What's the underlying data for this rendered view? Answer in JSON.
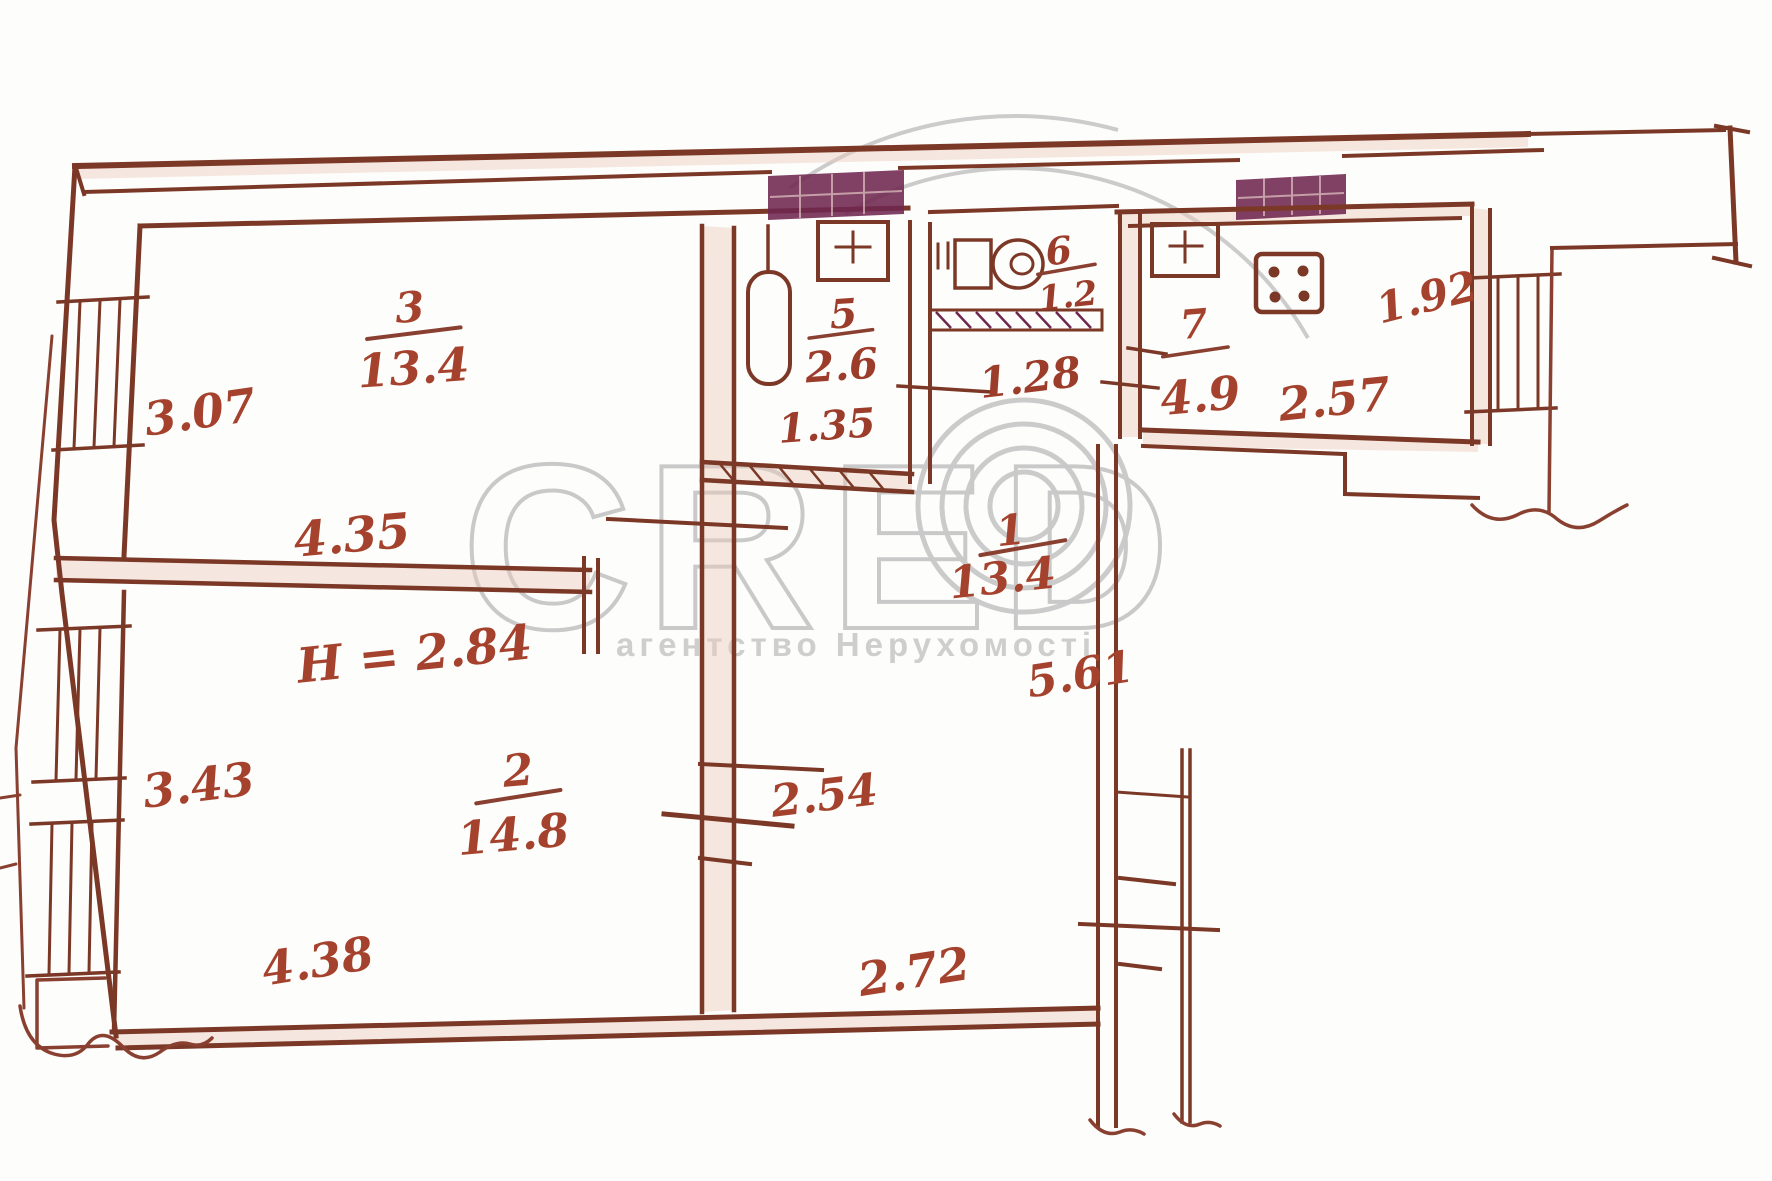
{
  "watermark": {
    "logo": "CRED",
    "tagline": "агентство Нерухомості"
  },
  "plan": {
    "ceiling_height": "H = 2.84",
    "rooms": {
      "living_top": {
        "number": "3",
        "area": "13.4"
      },
      "living_bottom": {
        "number": "2",
        "area": "14.8"
      },
      "hall": {
        "number": "1",
        "area": "13.4"
      },
      "bathroom": {
        "number": "5",
        "area": "2.6"
      },
      "wc": {
        "number": "6",
        "area": "1.2"
      },
      "kitchen": {
        "number": "7",
        "area": "4.9"
      }
    },
    "dims": {
      "room3_depth": "3.07",
      "room3_width": "4.35",
      "room2_depth": "3.43",
      "room2_width": "4.38",
      "hall_len": "5.61",
      "hall_w1": "2.54",
      "hall_w2": "2.72",
      "bath_width": "1.35",
      "lobby_width": "1.28",
      "kitchen_width": "2.57",
      "kitchen_depth": "1.92"
    },
    "colors": {
      "ink": "#7c3826",
      "label_ink": "#a5422e",
      "vent_fill": "#6e2750",
      "watermark_gray": "#c6c6c6"
    }
  }
}
